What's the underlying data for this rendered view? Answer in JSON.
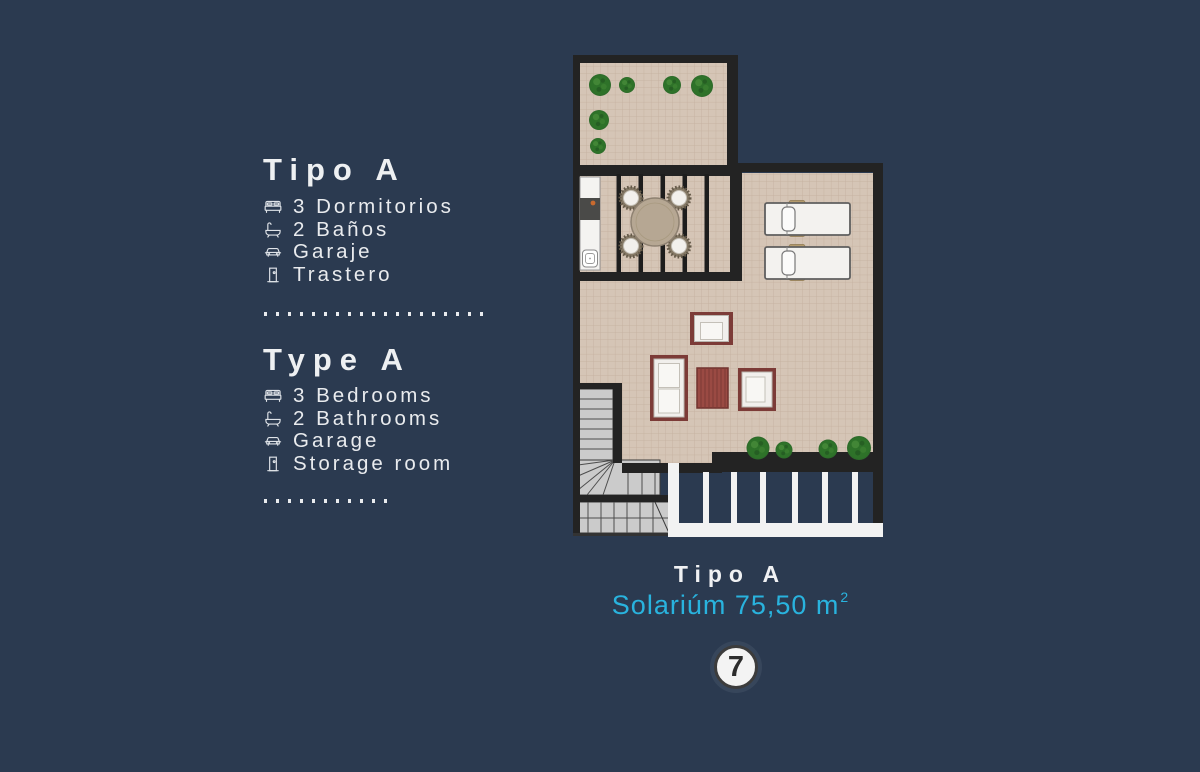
{
  "colors": {
    "background": "#2b3a50",
    "text": "#e9ebee",
    "accent_cyan": "#29b3de",
    "plan_wall": "#232323",
    "plan_floor": "#d5c5b6",
    "plan_furniture_frame": "#7c3b37",
    "plan_plant_green": "#2d6b2a",
    "plan_stairs_gray": "#cbcbcb"
  },
  "info_es": {
    "title": "Tipo A",
    "items": [
      {
        "icon": "bed-icon",
        "label": "3 Dormitorios"
      },
      {
        "icon": "bath-icon",
        "label": "2 Baños"
      },
      {
        "icon": "car-icon",
        "label": "Garaje"
      },
      {
        "icon": "door-icon",
        "label": "Trastero"
      }
    ]
  },
  "info_en": {
    "title": "Type A",
    "items": [
      {
        "icon": "bed-icon",
        "label": "3 Bedrooms"
      },
      {
        "icon": "bath-icon",
        "label": "2 Bathrooms"
      },
      {
        "icon": "car-icon",
        "label": "Garage"
      },
      {
        "icon": "door-icon",
        "label": "Storage room"
      }
    ]
  },
  "caption": {
    "title": "Tipo A",
    "area_text": "Solariúm 75,50 m",
    "area_sup": "2",
    "unit_number": "7"
  }
}
